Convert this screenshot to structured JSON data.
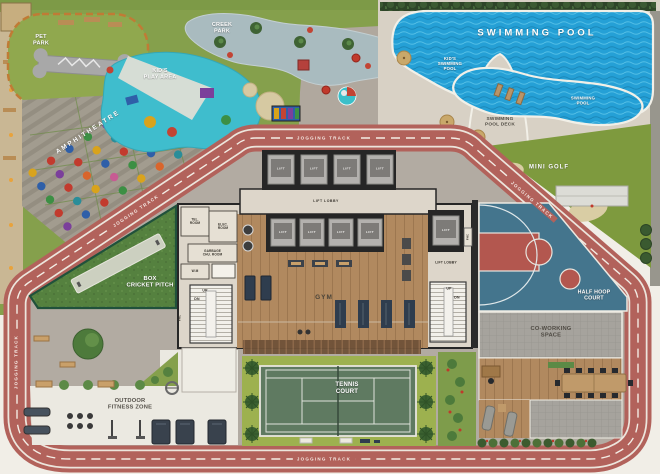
{
  "colors": {
    "jogging_track": "#b2625b",
    "track_line": "#ece5dc",
    "pool_water": "#25a0d6",
    "pool_deck": "#d8d1c5",
    "park_grass": "#85a04c",
    "mini_golf_green": "#7e9a3e",
    "cricket_green": "#55813f",
    "court_blue": "#44758d",
    "court_red": "#b3574f",
    "tennis_court": "#5f7a61",
    "tennis_lawn": "#9db14f",
    "gym_wood": "#b1895f",
    "building_wall": "#262626",
    "building_floor": "#ddd6ca",
    "paving_grey": "#b2aba2",
    "fitness_paving": "#ebe9e1",
    "coworking_grey": "#a6a39d",
    "kids_area_teal": "#3fbdcd",
    "creek_grey": "#a9bbbf"
  },
  "labels": {
    "pet_park": "PET\nPARK",
    "creek_park": "CREEK\nPARK",
    "kids_play_area": "KID'S\nPLAY AREA",
    "amphitheatre": "AMPHITHEATRE",
    "swimming_pool": "SWIMMING POOL",
    "kids_swimming_pool": "KID'S\nSWIMMING\nPOOL",
    "swimming_pool_small": "SWIMMING\nPOOL",
    "swimming_pool_deck": "SWIMMING\nPOOL DECK",
    "mini_golf": "MINI GOLF",
    "jogging_track": "JOGGING TRACK",
    "lift": "LIFT",
    "lift_lobby": "LIFT LOBBY",
    "tel_room": "TEL.\nROOM",
    "elec_room": "ELEC.\nROOM",
    "garbage_chute_room": "GARBAGE\nCHU. ROOM",
    "washing_machine": "W.M",
    "up": "UP",
    "dn": "DN",
    "fhc": "FHC",
    "box_cricket_pitch": "BOX\nCRICKET PITCH",
    "gym": "GYM",
    "tennis_court": "TENNIS\nCOURT",
    "outdoor_fitness_zone": "OUTDOOR\nFITNESS ZONE",
    "half_hoop_court": "HALF HOOP\nCOURT",
    "co_working_space": "CO-WORKING\nSPACE"
  }
}
